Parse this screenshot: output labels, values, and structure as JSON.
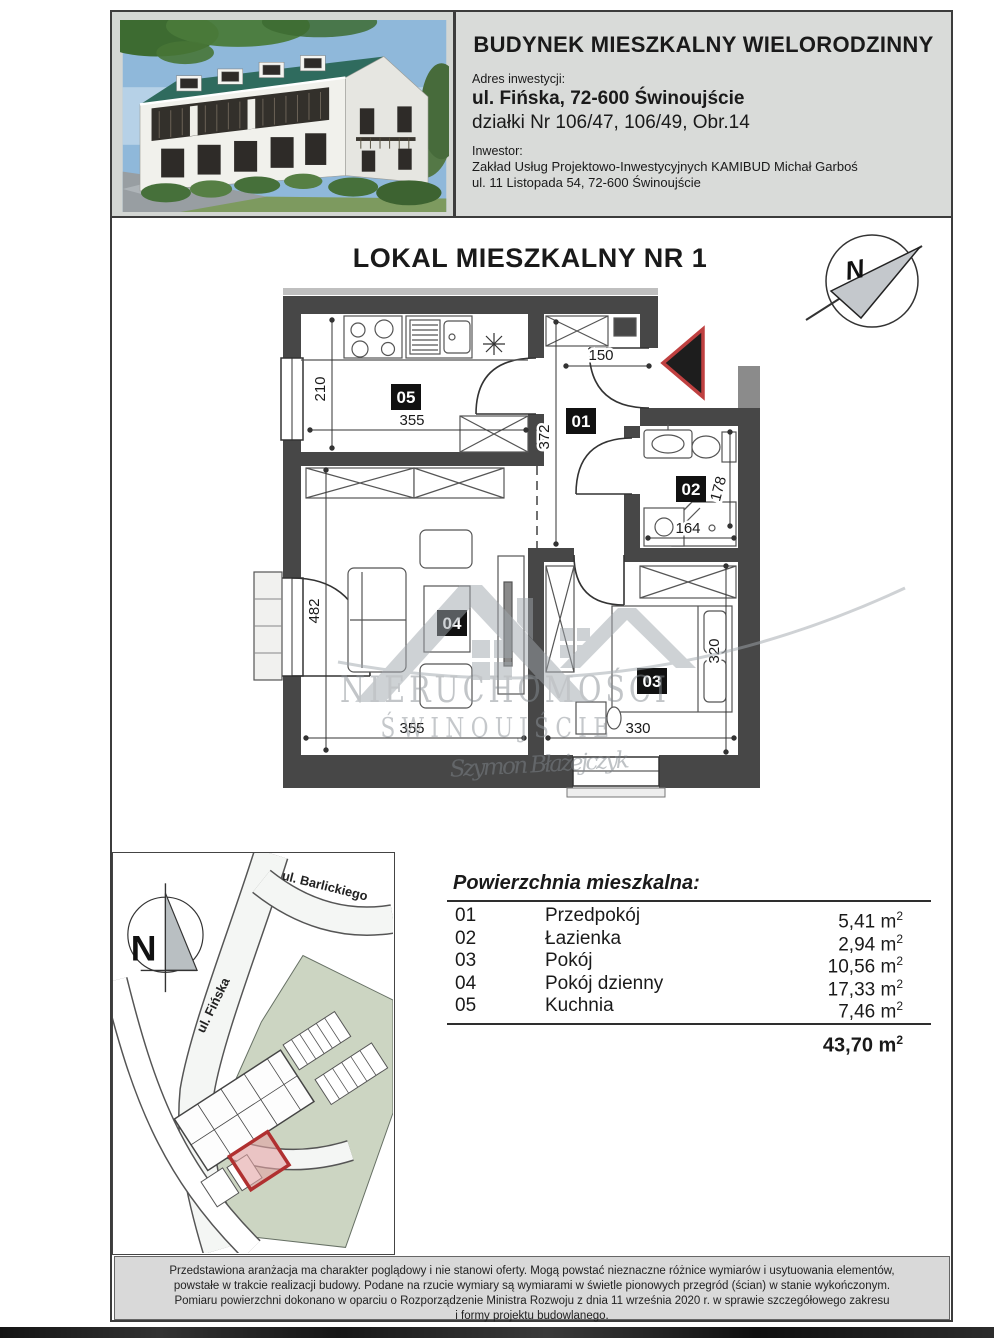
{
  "header": {
    "title": "BUDYNEK MIESZKALNY WIELORODZINNY",
    "address_label": "Adres inwestycji:",
    "address_line1": "ul. Fińska, 72-600 Świnoujście",
    "address_line2": "działki Nr 106/47, 106/49, Obr.14",
    "investor_label": "Inwestor:",
    "investor_line1": "Zakład Usług Projektowo-Inwestycyjnych KAMIBUD Michał Garboś",
    "investor_line2": "ul. 11 Listopada 54, 72-600 Świnoujście"
  },
  "plan": {
    "title": "LOKAL MIESZKALNY NR 1",
    "north_label": "N",
    "rooms": {
      "hall": "01",
      "bath": "02",
      "bedroom": "03",
      "living": "04",
      "kitchen": "05"
    },
    "dims": {
      "kitchen_width": "355",
      "kitchen_height": "210",
      "entry_width": "150",
      "hall_height": "372",
      "bath_width": "164",
      "bath_height": "178",
      "living_width": "355",
      "living_height": "482",
      "bedroom_width": "330",
      "bedroom_height": "320"
    }
  },
  "watermark": {
    "line1": "NIERUCHOMOŚCI",
    "line2": "ŚWINOUJŚCIE",
    "signature": "Szymon Błażejczyk"
  },
  "site_plan": {
    "north_label": "N",
    "street_top": "ul. Barlickiego",
    "street_side": "ul. Fińska"
  },
  "area_table": {
    "title": "Powierzchnia mieszkalna:",
    "unit_base": "m",
    "unit_sup": "2",
    "rows": [
      {
        "no": "01",
        "name": "Przedpokój",
        "area": "5,41"
      },
      {
        "no": "02",
        "name": "Łazienka",
        "area": "2,94"
      },
      {
        "no": "03",
        "name": "Pokój",
        "area": "10,56"
      },
      {
        "no": "04",
        "name": "Pokój dzienny",
        "area": "17,33"
      },
      {
        "no": "05",
        "name": "Kuchnia",
        "area": "7,46"
      }
    ],
    "total": "43,70"
  },
  "disclaimer": {
    "line1": "Przedstawiona aranżacja ma charakter poglądowy i nie stanowi oferty. Mogą powstać nieznaczne różnice wymiarów i usytuowania elementów,",
    "line2": "powstałe w trakcie realizacji budowy. Podane na rzucie wymiary są wymiarami w świetle pionowych przegród (ścian) w stanie wykończonym.",
    "line3": "Pomiaru powierzchni dokonano w oparciu o Rozporządzenie Ministra Rozwoju z dnia 11 września 2020 r. w sprawie szczegółowego zakresu",
    "line4": "i formy projektu budowlanego."
  }
}
